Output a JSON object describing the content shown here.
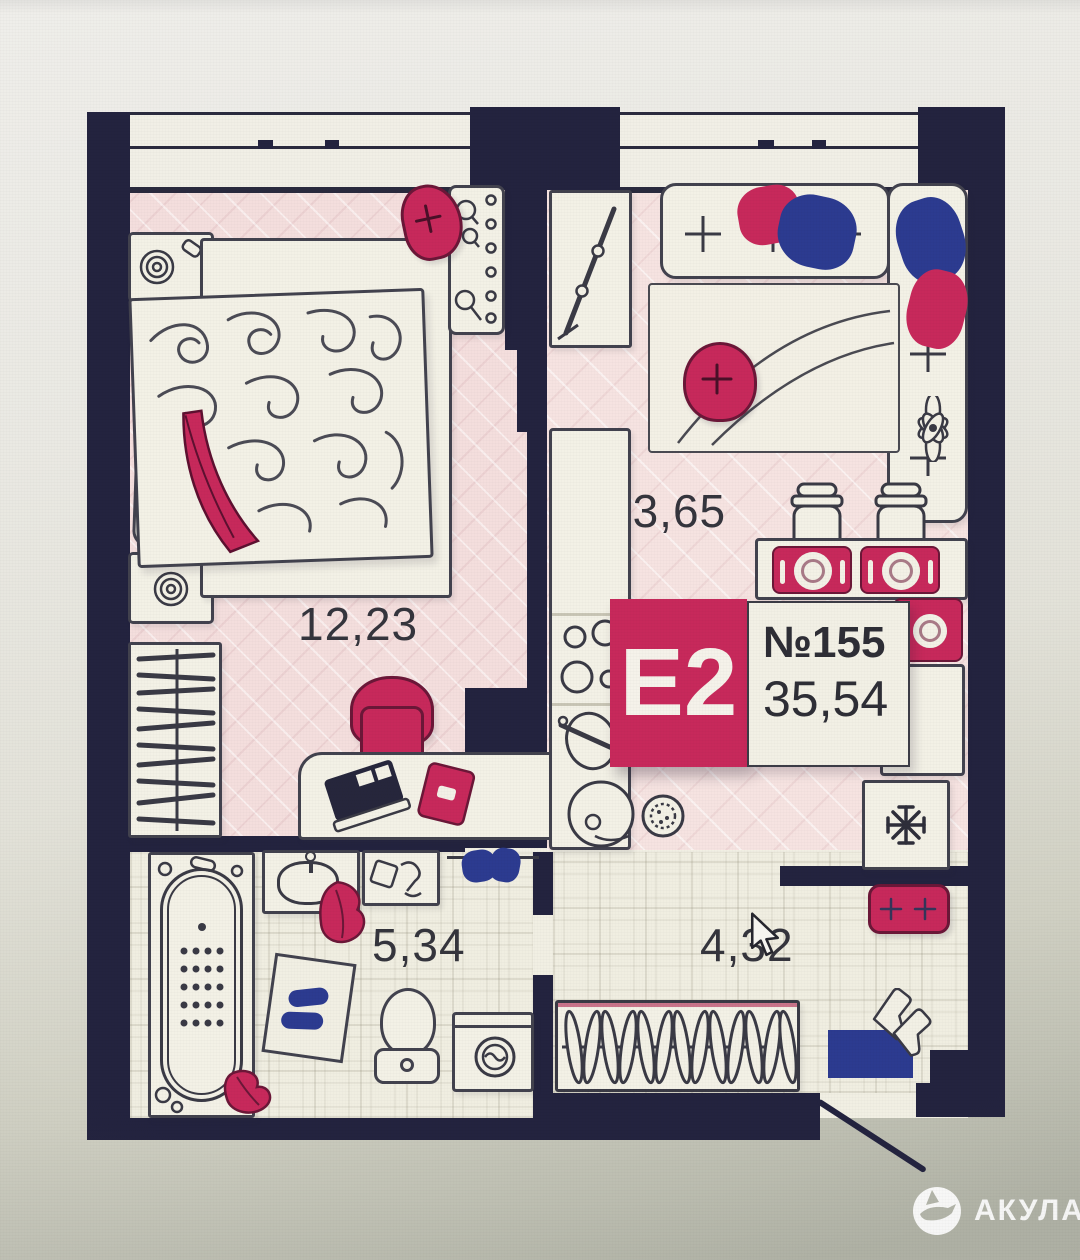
{
  "plan": {
    "unit": {
      "type": "Е2",
      "number": "№155",
      "area_total": "35,54"
    },
    "rooms": [
      {
        "id": "kitchen-living",
        "area": "13,65"
      },
      {
        "id": "bedroom",
        "area": "12,23"
      },
      {
        "id": "bathroom",
        "area": "5,34"
      },
      {
        "id": "hallway",
        "area": "4,32"
      }
    ],
    "colors": {
      "wall": "#23233f",
      "accent_crimson": "#c7295b",
      "accent_blue": "#2c3b90",
      "floor_pink": "#f4dedd",
      "floor_cream": "#f0eee1",
      "label_text": "#35353d"
    },
    "icons": [
      "snowflake-icon",
      "flower-icon",
      "shark-icon",
      "cursor-icon"
    ]
  },
  "watermark": {
    "label": "АКУЛА"
  }
}
